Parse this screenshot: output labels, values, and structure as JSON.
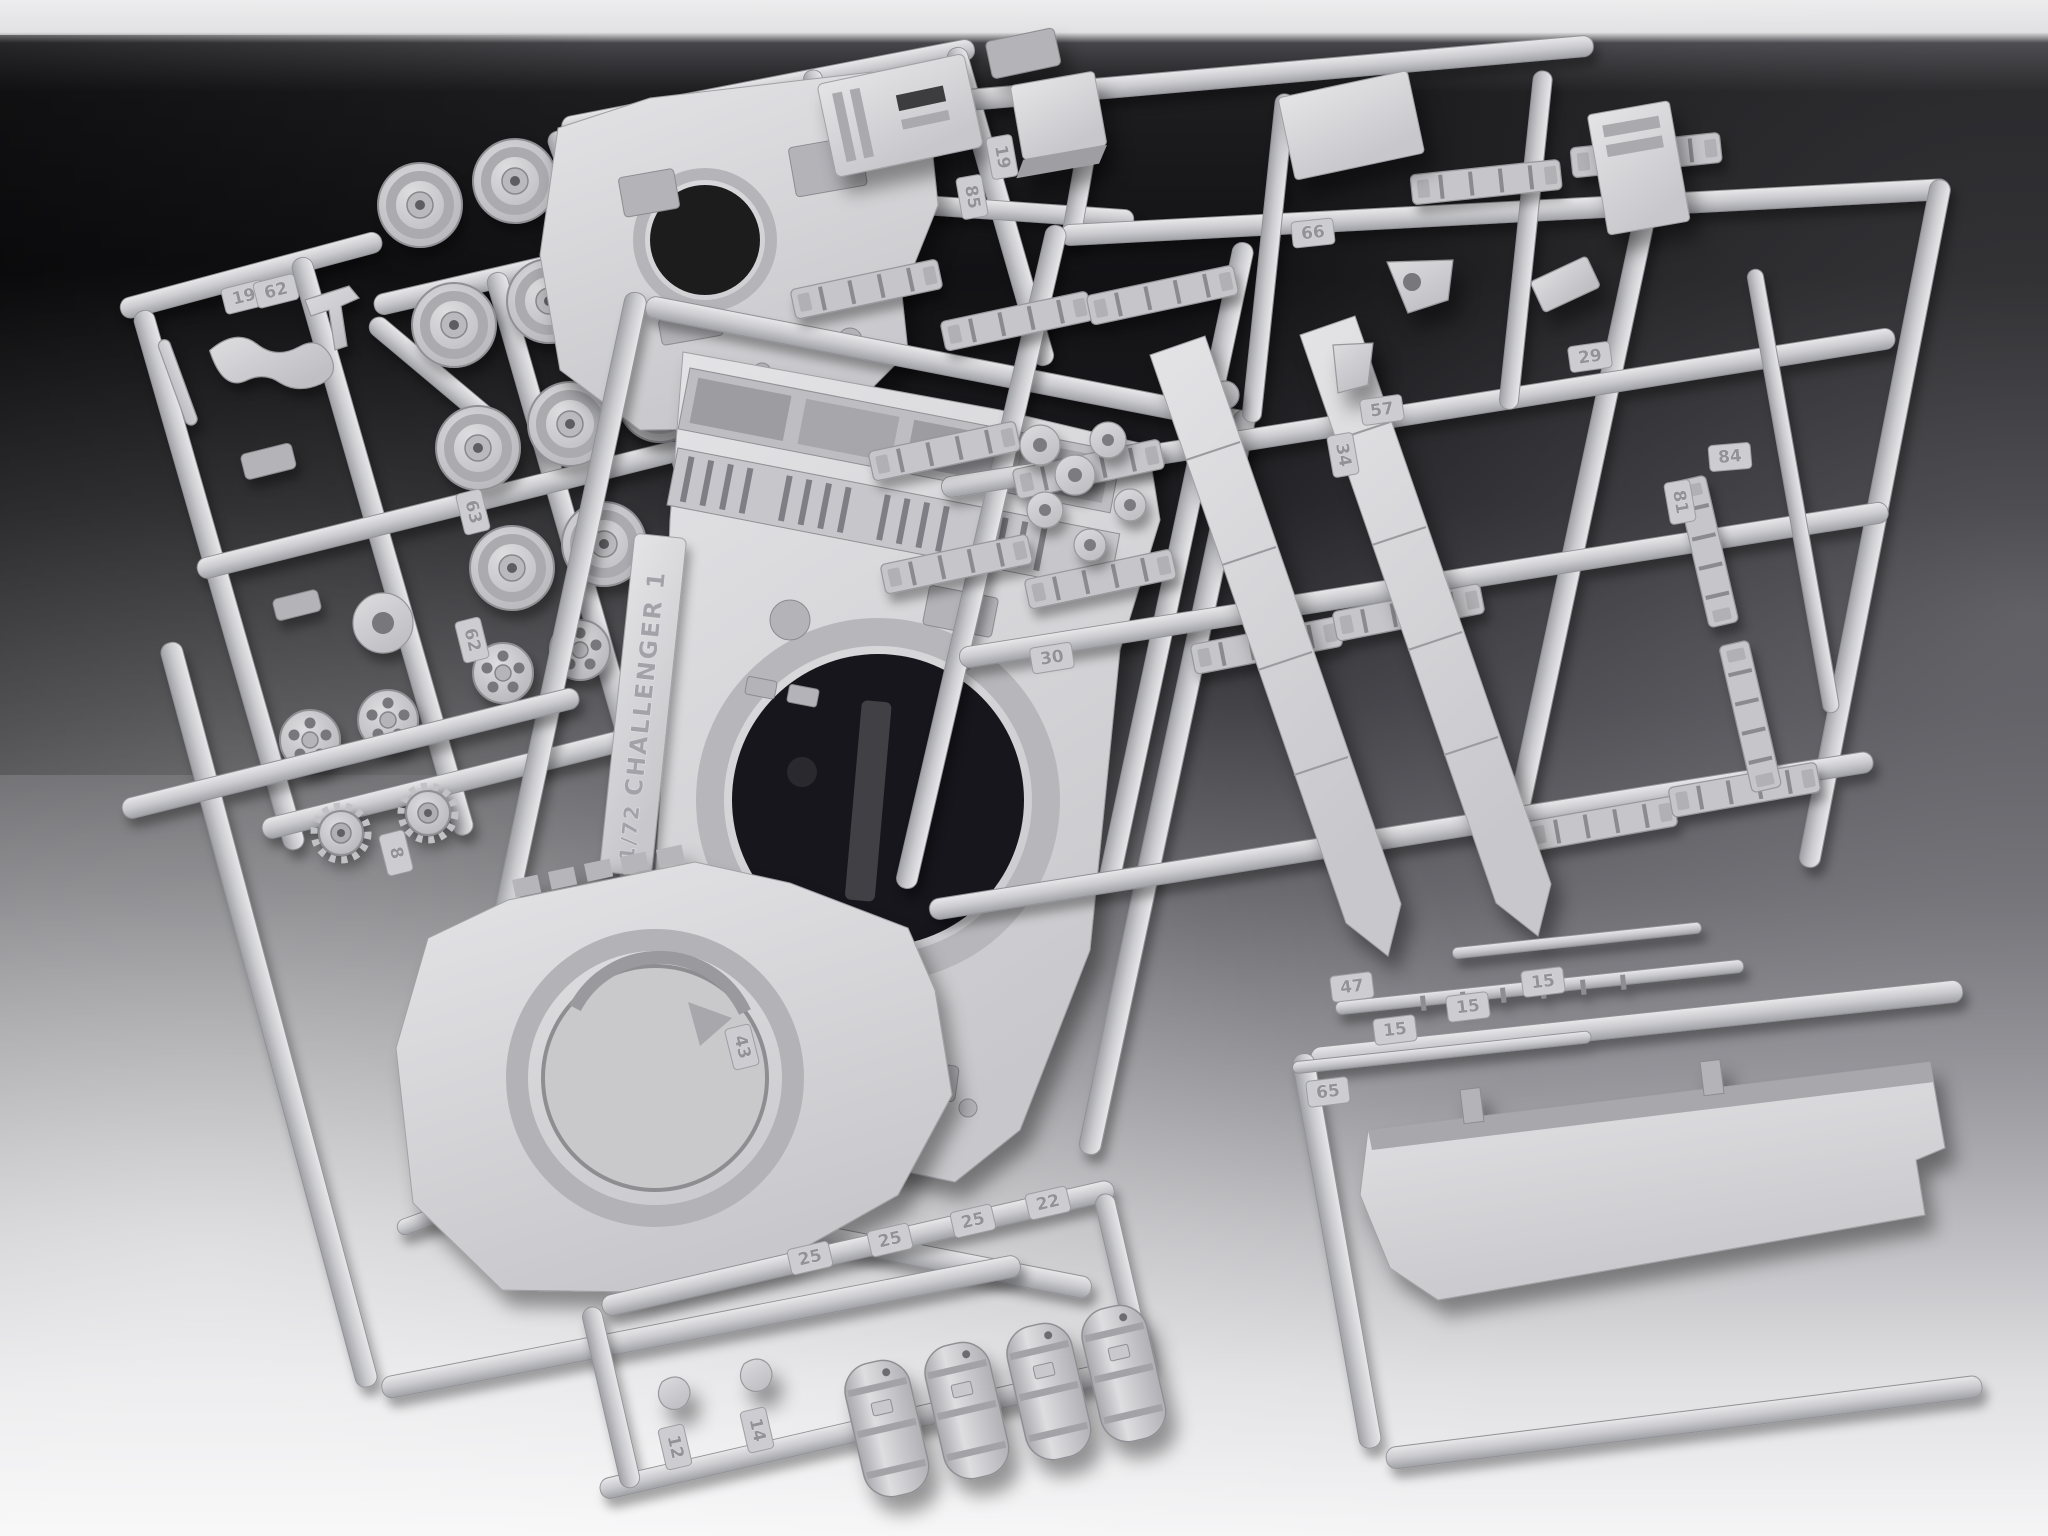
{
  "scene": {
    "type": "photograph",
    "subject": "Injection-moulded polystyrene model-kit sprues of a Challenger 1 tank kit on a studio gradient backdrop",
    "plastic_color": "#cbcbcf",
    "plastic_highlight": "#e6e6e9",
    "plastic_shadow": "#95959a",
    "background_top": "#141416",
    "background_bottom": "#f4f4f6",
    "top_edge_band": "#ededee"
  },
  "label_plate": {
    "scale": "1/72",
    "kit_name": "CHALLENGER 1"
  },
  "part_tags": [
    {
      "n": "19",
      "x": 244,
      "y": 297,
      "r": -14
    },
    {
      "n": "62",
      "x": 276,
      "y": 291,
      "r": -14
    },
    {
      "n": "63",
      "x": 473,
      "y": 512,
      "r": 76
    },
    {
      "n": "62",
      "x": 472,
      "y": 640,
      "r": 76
    },
    {
      "n": "8",
      "x": 396,
      "y": 853,
      "r": 76
    },
    {
      "n": "85",
      "x": 972,
      "y": 197,
      "r": 80
    },
    {
      "n": "19",
      "x": 1002,
      "y": 157,
      "r": 80
    },
    {
      "n": "66",
      "x": 1313,
      "y": 233,
      "r": -6
    },
    {
      "n": "29",
      "x": 1590,
      "y": 357,
      "r": -8
    },
    {
      "n": "57",
      "x": 1382,
      "y": 410,
      "r": -8
    },
    {
      "n": "34",
      "x": 1343,
      "y": 455,
      "r": 80
    },
    {
      "n": "84",
      "x": 1730,
      "y": 457,
      "r": -5
    },
    {
      "n": "81",
      "x": 1680,
      "y": 502,
      "r": 80
    },
    {
      "n": "30",
      "x": 1052,
      "y": 658,
      "r": -9
    },
    {
      "n": "43",
      "x": 742,
      "y": 1047,
      "r": 76
    },
    {
      "n": "47",
      "x": 1352,
      "y": 987,
      "r": -7
    },
    {
      "n": "65",
      "x": 1328,
      "y": 1092,
      "r": -7
    },
    {
      "n": "15",
      "x": 1395,
      "y": 1030,
      "r": -7
    },
    {
      "n": "15",
      "x": 1468,
      "y": 1007,
      "r": -7
    },
    {
      "n": "15",
      "x": 1543,
      "y": 982,
      "r": -7
    },
    {
      "n": "25",
      "x": 810,
      "y": 1258,
      "r": -13
    },
    {
      "n": "25",
      "x": 890,
      "y": 1240,
      "r": -13
    },
    {
      "n": "25",
      "x": 973,
      "y": 1221,
      "r": -13
    },
    {
      "n": "22",
      "x": 1048,
      "y": 1203,
      "r": -13
    },
    {
      "n": "12",
      "x": 675,
      "y": 1447,
      "r": 77
    },
    {
      "n": "14",
      "x": 757,
      "y": 1430,
      "r": 77
    }
  ],
  "visible_parts": [
    "turret top shell with ring opening",
    "upper hull with engine deck grilles and turret ring opening",
    "turret base plate with ring opening",
    "two angled side-skirt panels",
    "road wheels and drive sprockets",
    "track-link strips",
    "four stowage drums",
    "stowage boxes and brackets",
    "hull belly panel",
    "ribbed gun-barrel rods"
  ]
}
